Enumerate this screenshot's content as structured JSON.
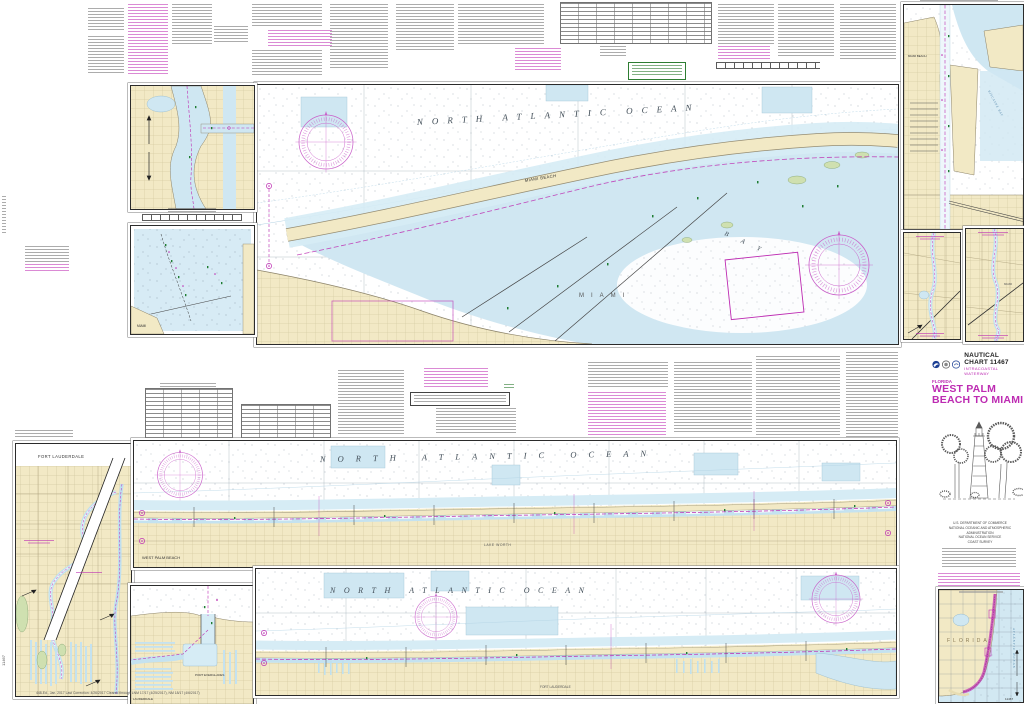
{
  "chart": {
    "number": "11467",
    "header_label": "NAUTICAL CHART 11467",
    "series": "INTRACOASTAL WATERWAY",
    "state": "FLORIDA",
    "title": "WEST PALM BEACH TO MIAMI"
  },
  "labels": {
    "ocean_upper": "NORTH ATLANTIC OCEAN",
    "ocean_mid": "NORTH ATLANTIC OCEAN",
    "ocean_lower": "NORTH ATLANTIC OCEAN",
    "miami_beach": "MIAMI BEACH",
    "miami": "MIAMI",
    "bay": "BAY",
    "biscayne_bay": "BISCAYNE BAY",
    "west_palm_beach": "WEST PALM BEACH",
    "lake_worth": "LAKE WORTH",
    "fort_lauderdale": "FORT LAUDERDALE",
    "lauderdale": "LAUDERDALE",
    "port_everglades": "PORT EVERGLADES",
    "index_state": "FLORIDA",
    "index_ocean": "ATLANTIC OCEAN"
  },
  "publisher": {
    "line1": "U.S. DEPARTMENT OF COMMERCE",
    "line2": "NATIONAL OCEANIC AND ATMOSPHERIC ADMINISTRATION",
    "line3": "NATIONAL OCEAN SERVICE",
    "line4": "COAST SURVEY"
  },
  "imprint": "448-Ed., Jan. 2017  Last Correction: 4/26/2017  Cleared through LNM 17/17 (4/25/2017), NM 18/17 (4/6/2017)",
  "colors": {
    "magenta": "#bd2bb2",
    "land": "#f2e9c5",
    "landdark": "#e7dcb2",
    "shallow": "#cfe7f2",
    "marsh": "#cfe0b0",
    "green": "#2e7d32",
    "ink": "#333333"
  }
}
